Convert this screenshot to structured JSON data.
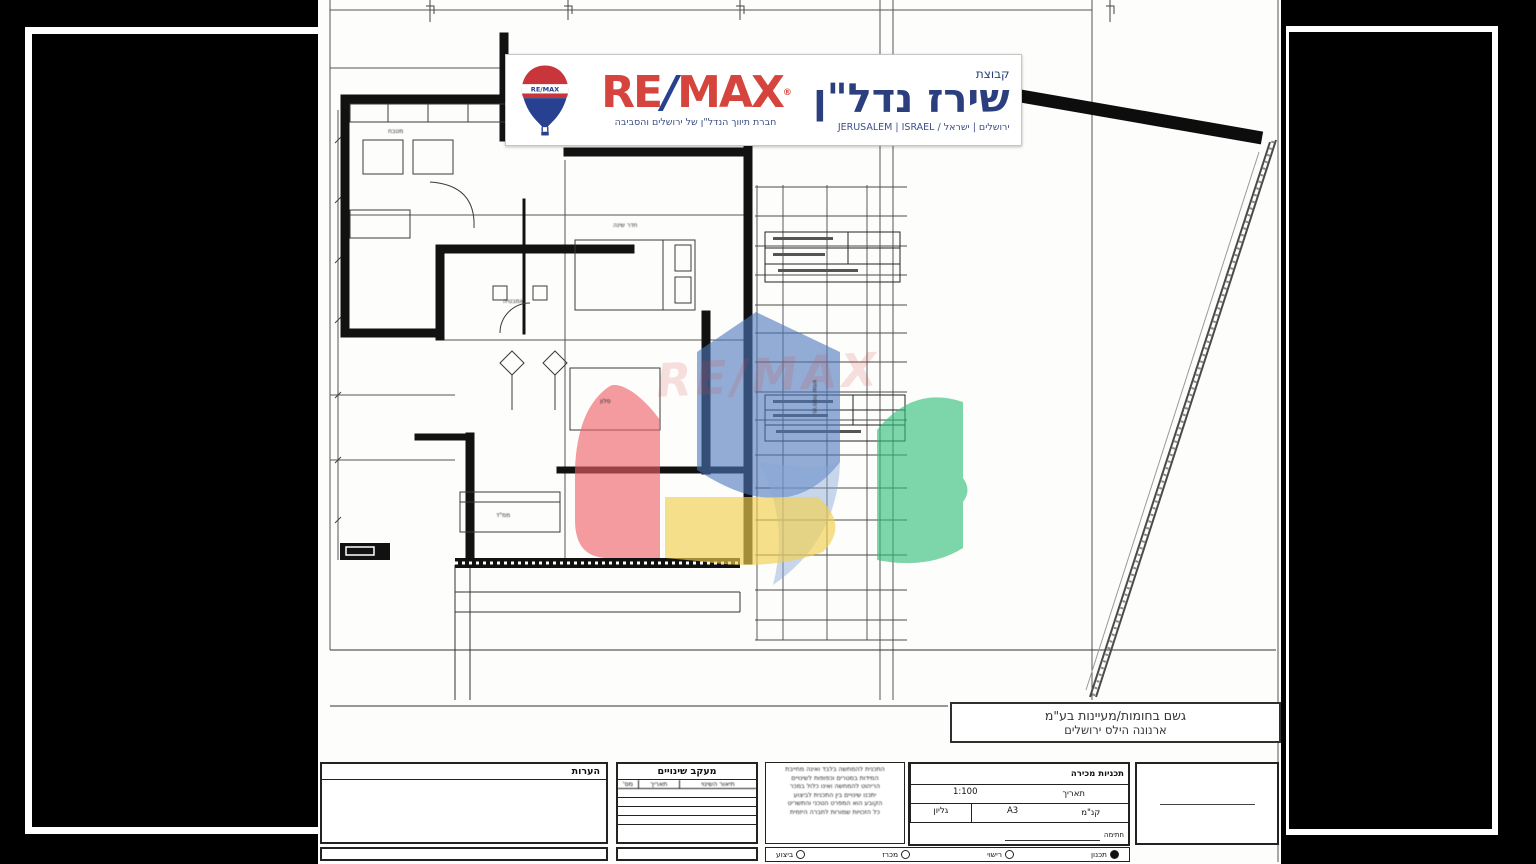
{
  "banner": {
    "group_label": "קבוצת",
    "agency_name": "שירז נדל\"ן",
    "brand_re": "RE",
    "brand_slash": "/",
    "brand_max": "MAX",
    "registered_mark": "®",
    "balloon_text": "RE/MAX",
    "tagline_en": "JERUSALEM | ISRAEL  /  ירושלים | ישראל",
    "tagline_he": "חברת תיווך הנדל\"ן של ירושלים והסביבה",
    "colors": {
      "red": "#D6453D",
      "navy": "#27408F"
    }
  },
  "watermark": {
    "text": "RE/MAX",
    "colors": {
      "blue": "#4D76BA",
      "light_blue": "#88A7D6",
      "red": "#EE6066",
      "yellow": "#F3CF4E",
      "green": "#2FBE77"
    }
  },
  "company_box": {
    "line1": "גשם בחומות/מעיינות בע\"מ",
    "line2": "ארנונה הילס ירושלים"
  },
  "plan": {
    "labels": [
      {
        "text": "מטבח"
      },
      {
        "text": "אמבטיה"
      },
      {
        "text": "חדר שינה"
      },
      {
        "text": "סלון"
      },
      {
        "text": "ממ\"ד"
      },
      {
        "text": "מרפסת שמש"
      }
    ]
  },
  "title_block": {
    "notes_header": "הערות",
    "changes_header": "מעקב שינויים",
    "changes_columns": [
      "תיאור השינוי",
      "תאריך",
      "מס'"
    ],
    "disclaimer_lines": [
      "התכנית להמחשה בלבד ואינה מחייבת",
      "המידות במטרים וכפופות לשינויים",
      "הריהוט להמחשה ואינו כלול במכר",
      "יתכנו שינויים בין התכנית לביצוע",
      "הקובע הוא המפרט הטכני והתשריט",
      "כל הזכויות שמורות לחברה היזמית"
    ],
    "project_row": "תכניות מכירה",
    "scale_value": "1:100",
    "date_label": "תאריך",
    "sheet_size": "A3",
    "scale_label": "קנ\"מ",
    "sheet_label": "גליון",
    "signature_label": "חתימה",
    "statuses": [
      {
        "label": "תכנון"
      },
      {
        "label": "רישוי"
      },
      {
        "label": "מכרז"
      },
      {
        "label": "ביצוע"
      }
    ]
  }
}
